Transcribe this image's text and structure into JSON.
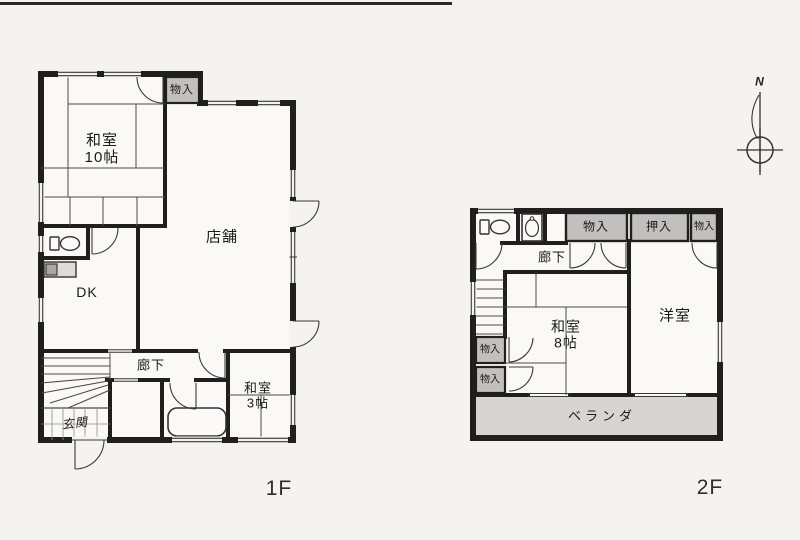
{
  "page": {
    "floor1_label": "1F",
    "floor2_label": "2F",
    "compass_n": "N"
  },
  "floor1": {
    "rooms": {
      "washitsu10": {
        "name": "和室",
        "size": "10帖"
      },
      "monoire": {
        "name": "物入"
      },
      "tenpo": {
        "name": "店舗"
      },
      "dk": {
        "name": "DK"
      },
      "rouka": {
        "name": "廊下"
      },
      "washitsu3": {
        "name": "和室",
        "size": "3帖"
      },
      "genkan": {
        "name": "玄関"
      }
    }
  },
  "floor2": {
    "rooms": {
      "rouka": {
        "name": "廊下"
      },
      "monoire_top1": {
        "name": "物入"
      },
      "oshiire": {
        "name": "押入"
      },
      "monoire_top2": {
        "name": "物入"
      },
      "monoire_left1": {
        "name": "物入"
      },
      "monoire_left2": {
        "name": "物入"
      },
      "washitsu8": {
        "name": "和室",
        "size": "8帖"
      },
      "youshitsu": {
        "name": "洋室"
      },
      "veranda": {
        "name": "ベランダ"
      }
    }
  },
  "colors": {
    "wall": "#1f1f1f",
    "closet_fill": "#c1c0be",
    "veranda_fill": "#d6d5d2",
    "room_fill": "#faf9f6",
    "paper": "#f4f3f0"
  }
}
